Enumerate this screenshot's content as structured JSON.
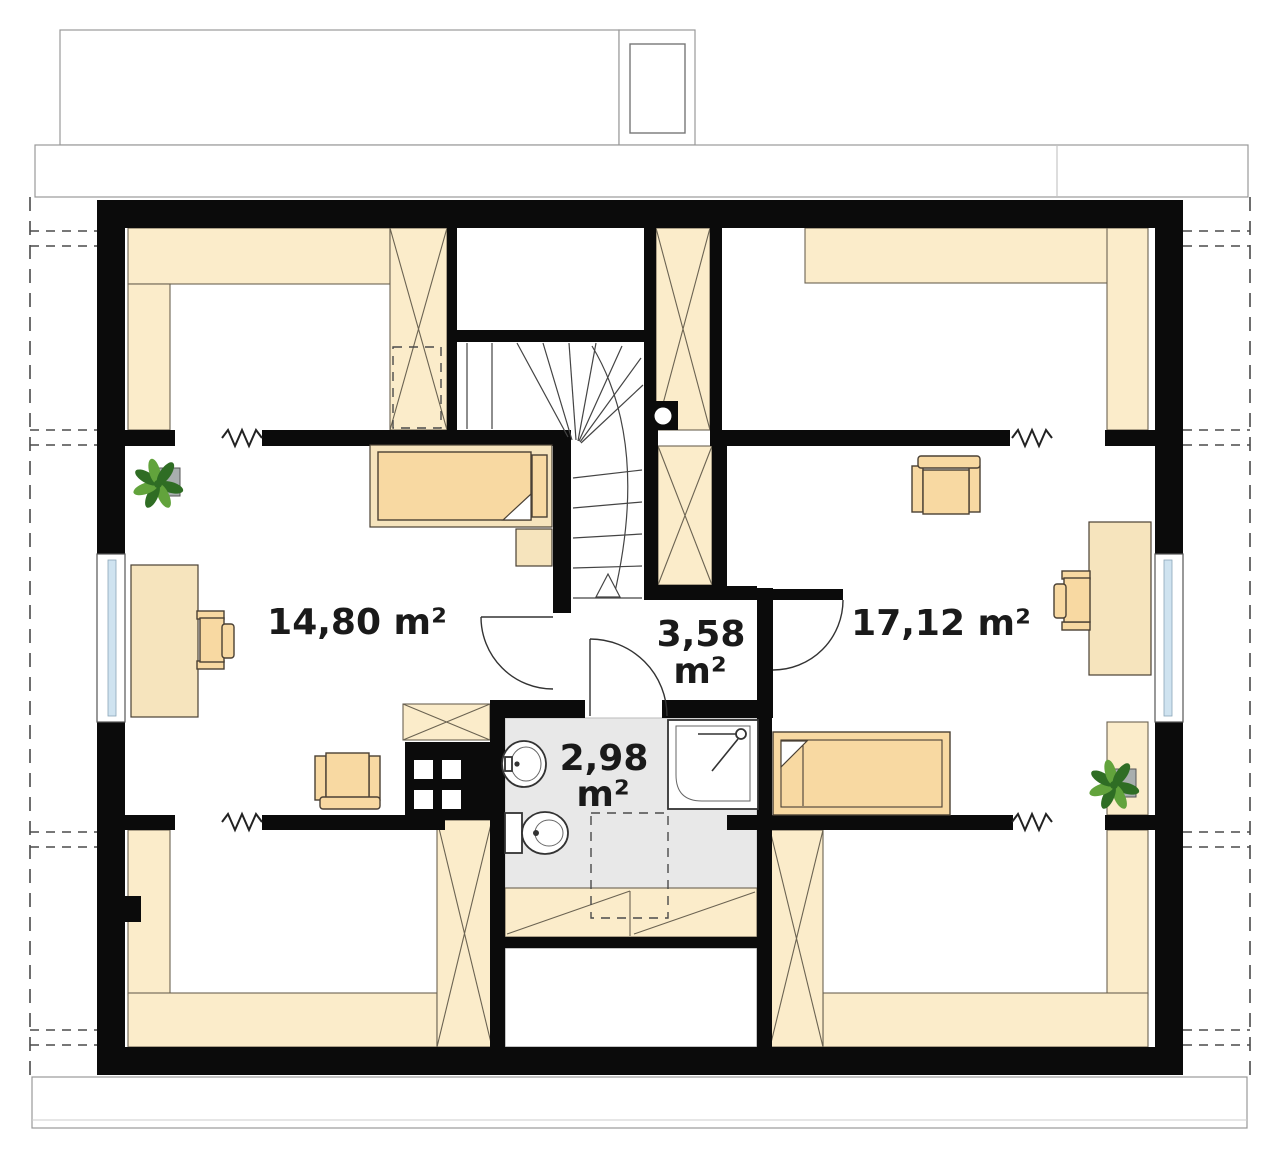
{
  "plan_title": "Attic floor plan",
  "rooms": {
    "bedroom_left": {
      "area": "14,80 m²"
    },
    "bedroom_right": {
      "area": "17,12 m²"
    },
    "hallway": {
      "area_value": "3,58",
      "area_unit": "m²"
    },
    "bathroom": {
      "area_value": "2,98",
      "area_unit": "m²"
    }
  },
  "colors": {
    "wall": "#0b0b0b",
    "cream": "#fbecca",
    "bed": "#f8d9a2",
    "platform": "#f6e4bd",
    "bathfloor": "#e8e8e8",
    "glass": "#cfe3f0",
    "plantdark": "#2f6d24",
    "plantlight": "#62a33c",
    "outline": "#6b6352",
    "linegray": "#999999",
    "dashcolor": "#4a4a4a",
    "textcolor": "#1a1a1a",
    "potgray": "#a8aeae",
    "fixture": "#333333"
  }
}
